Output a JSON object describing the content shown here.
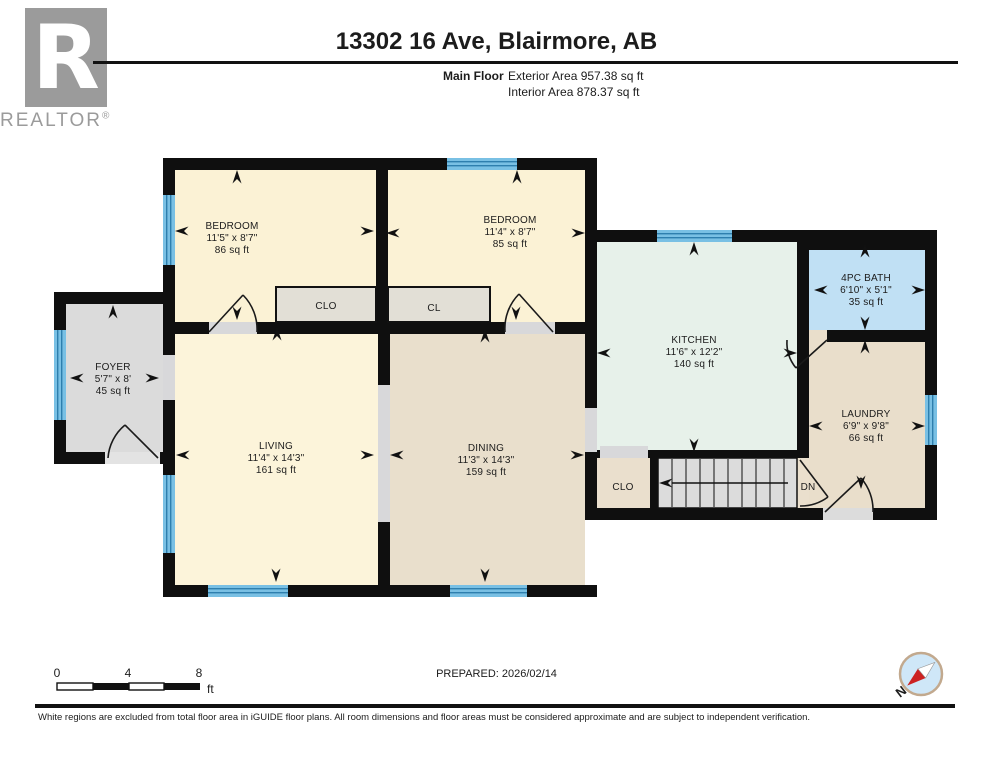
{
  "header": {
    "title": "13302 16 Ave, Blairmore, AB",
    "floor_label": "Main Floor",
    "exterior_area": "Exterior Area 957.38 sq ft",
    "interior_area": "Interior Area 878.37 sq ft",
    "logo_letter": "R",
    "logo_text": "REALTOR",
    "logo_reg": "®"
  },
  "rooms": [
    {
      "name": "BEDROOM",
      "dims": "11'5\" x 8'7\"",
      "area": "86 sq ft"
    },
    {
      "name": "BEDROOM",
      "dims": "11'4\" x 8'7\"",
      "area": "85 sq ft"
    },
    {
      "name": "KITCHEN",
      "dims": "11'6\" x 12'2\"",
      "area": "140 sq ft"
    },
    {
      "name": "4PC BATH",
      "dims": "6'10\" x 5'1\"",
      "area": "35 sq ft"
    },
    {
      "name": "LAUNDRY",
      "dims": "6'9\" x 9'8\"",
      "area": "66 sq ft"
    },
    {
      "name": "FOYER",
      "dims": "5'7\" x 8'",
      "area": "45 sq ft"
    },
    {
      "name": "LIVING",
      "dims": "11'4\" x 14'3\"",
      "area": "161 sq ft"
    },
    {
      "name": "DINING",
      "dims": "11'3\" x 14'3\"",
      "area": "159 sq ft"
    }
  ],
  "labels": {
    "closet1": "CLO",
    "closet2": "CL",
    "hall_closet": "CLO",
    "stairs_down": "DN"
  },
  "scale_bar": {
    "tick0": "0",
    "tick4": "4",
    "tick8": "8",
    "unit": "ft"
  },
  "compass": {
    "north": "N"
  },
  "footer": {
    "prepared": "PREPARED: 2026/02/14",
    "disclaimer": "White regions are excluded from total floor area in iGUIDE floor plans. All room dimensions and floor areas must be considered approximate and are subject to independent verification."
  },
  "colors": {
    "wall": "#0f0f0f",
    "window_blue": "#79c0e4",
    "window_line": "#2e7fae",
    "bedroom_cream": "#fbf2d5",
    "dining_tan": "#e9dfcc",
    "kitchen_mint": "#e7f1ea",
    "bath_blue": "#c0e0f4",
    "foyer_gray": "#dbdbdb",
    "closet_gray": "#e2dfd6",
    "compass_red": "#cc2222",
    "logo_gray": "#9b9b9b"
  }
}
